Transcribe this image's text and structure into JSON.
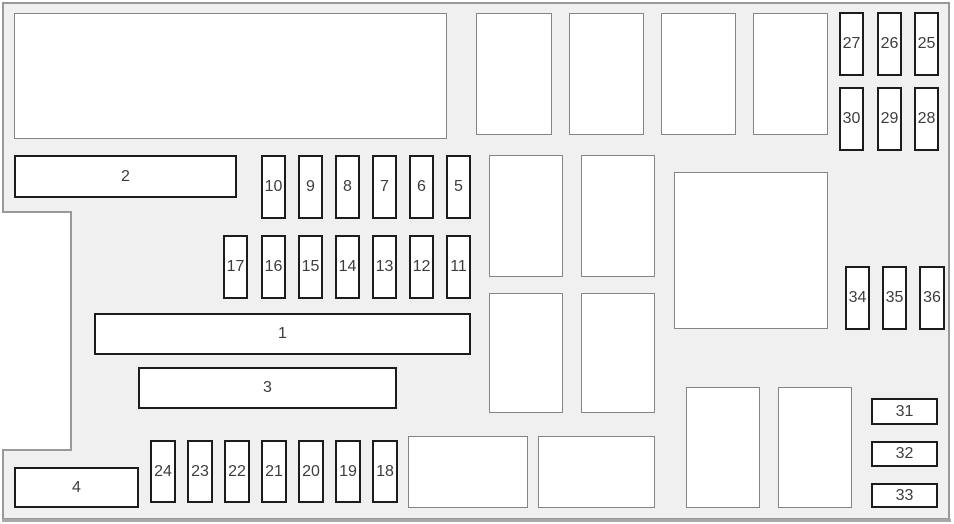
{
  "diagram": {
    "name": "fuse-box-layout-diagram",
    "colors": {
      "panel_fill": "#f0f0f0",
      "panel_stroke": "#999999",
      "panel_bottom_edge": "#a8a8a8",
      "slot_fill": "#ffffff",
      "bold_border": "#1c1c1c",
      "light_border": "#848484",
      "label_text": "#3d3d3d"
    },
    "outline_points": "3,3 949,3 949,519 3,519 3,450 71,450 71,212 3,212",
    "bottom_edge": {
      "x1": 2,
      "y1": 520.5,
      "x2": 951,
      "y2": 520.5,
      "width": 3
    },
    "boxes": [
      {
        "id": "fuse-strip-2",
        "label": "2",
        "x": 14,
        "y": 155,
        "w": 223,
        "h": 43,
        "style": "bold"
      },
      {
        "id": "fuse-strip-1",
        "label": "1",
        "x": 94,
        "y": 313,
        "w": 377,
        "h": 42,
        "style": "bold"
      },
      {
        "id": "fuse-strip-3",
        "label": "3",
        "x": 138,
        "y": 367,
        "w": 259,
        "h": 42,
        "style": "bold"
      },
      {
        "id": "fuse-strip-4",
        "label": "4",
        "x": 14,
        "y": 467,
        "w": 125,
        "h": 41,
        "style": "bold"
      },
      {
        "id": "fuse-10",
        "label": "10",
        "x": 261,
        "y": 155,
        "w": 25,
        "h": 64,
        "style": "bold"
      },
      {
        "id": "fuse-9",
        "label": "9",
        "x": 298,
        "y": 155,
        "w": 25,
        "h": 64,
        "style": "bold"
      },
      {
        "id": "fuse-8",
        "label": "8",
        "x": 335,
        "y": 155,
        "w": 25,
        "h": 64,
        "style": "bold"
      },
      {
        "id": "fuse-7",
        "label": "7",
        "x": 372,
        "y": 155,
        "w": 25,
        "h": 64,
        "style": "bold"
      },
      {
        "id": "fuse-6",
        "label": "6",
        "x": 409,
        "y": 155,
        "w": 25,
        "h": 64,
        "style": "bold"
      },
      {
        "id": "fuse-5",
        "label": "5",
        "x": 446,
        "y": 155,
        "w": 25,
        "h": 64,
        "style": "bold"
      },
      {
        "id": "fuse-17",
        "label": "17",
        "x": 223,
        "y": 235,
        "w": 25,
        "h": 64,
        "style": "bold"
      },
      {
        "id": "fuse-16",
        "label": "16",
        "x": 261,
        "y": 235,
        "w": 25,
        "h": 64,
        "style": "bold"
      },
      {
        "id": "fuse-15",
        "label": "15",
        "x": 298,
        "y": 235,
        "w": 25,
        "h": 64,
        "style": "bold"
      },
      {
        "id": "fuse-14",
        "label": "14",
        "x": 335,
        "y": 235,
        "w": 25,
        "h": 64,
        "style": "bold"
      },
      {
        "id": "fuse-13",
        "label": "13",
        "x": 372,
        "y": 235,
        "w": 25,
        "h": 64,
        "style": "bold"
      },
      {
        "id": "fuse-12",
        "label": "12",
        "x": 409,
        "y": 235,
        "w": 25,
        "h": 64,
        "style": "bold"
      },
      {
        "id": "fuse-11",
        "label": "11",
        "x": 446,
        "y": 235,
        "w": 25,
        "h": 64,
        "style": "bold"
      },
      {
        "id": "fuse-24",
        "label": "24",
        "x": 150,
        "y": 440,
        "w": 26,
        "h": 63,
        "style": "bold"
      },
      {
        "id": "fuse-23",
        "label": "23",
        "x": 187,
        "y": 440,
        "w": 26,
        "h": 63,
        "style": "bold"
      },
      {
        "id": "fuse-22",
        "label": "22",
        "x": 224,
        "y": 440,
        "w": 26,
        "h": 63,
        "style": "bold"
      },
      {
        "id": "fuse-21",
        "label": "21",
        "x": 261,
        "y": 440,
        "w": 26,
        "h": 63,
        "style": "bold"
      },
      {
        "id": "fuse-20",
        "label": "20",
        "x": 298,
        "y": 440,
        "w": 26,
        "h": 63,
        "style": "bold"
      },
      {
        "id": "fuse-19",
        "label": "19",
        "x": 335,
        "y": 440,
        "w": 26,
        "h": 63,
        "style": "bold"
      },
      {
        "id": "fuse-18",
        "label": "18",
        "x": 372,
        "y": 440,
        "w": 26,
        "h": 63,
        "style": "bold"
      },
      {
        "id": "fuse-27",
        "label": "27",
        "x": 839,
        "y": 12,
        "w": 25,
        "h": 64,
        "style": "bold"
      },
      {
        "id": "fuse-26",
        "label": "26",
        "x": 877,
        "y": 12,
        "w": 25,
        "h": 64,
        "style": "bold"
      },
      {
        "id": "fuse-25",
        "label": "25",
        "x": 914,
        "y": 12,
        "w": 25,
        "h": 64,
        "style": "bold"
      },
      {
        "id": "fuse-30",
        "label": "30",
        "x": 839,
        "y": 87,
        "w": 25,
        "h": 64,
        "style": "bold"
      },
      {
        "id": "fuse-29",
        "label": "29",
        "x": 877,
        "y": 87,
        "w": 25,
        "h": 64,
        "style": "bold"
      },
      {
        "id": "fuse-28",
        "label": "28",
        "x": 914,
        "y": 87,
        "w": 25,
        "h": 64,
        "style": "bold"
      },
      {
        "id": "fuse-34",
        "label": "34",
        "x": 845,
        "y": 266,
        "w": 25,
        "h": 64,
        "style": "bold"
      },
      {
        "id": "fuse-35",
        "label": "35",
        "x": 882,
        "y": 266,
        "w": 25,
        "h": 64,
        "style": "bold"
      },
      {
        "id": "fuse-36",
        "label": "36",
        "x": 919,
        "y": 266,
        "w": 26,
        "h": 64,
        "style": "bold"
      },
      {
        "id": "fuse-31",
        "label": "31",
        "x": 871,
        "y": 398,
        "w": 67,
        "h": 27,
        "style": "bold"
      },
      {
        "id": "fuse-32",
        "label": "32",
        "x": 871,
        "y": 441,
        "w": 67,
        "h": 26,
        "style": "bold"
      },
      {
        "id": "fuse-33",
        "label": "33",
        "x": 871,
        "y": 483,
        "w": 67,
        "h": 25,
        "style": "bold"
      },
      {
        "id": "module-slot-top-left",
        "label": "",
        "x": 14,
        "y": 13,
        "w": 433,
        "h": 126,
        "style": "light"
      },
      {
        "id": "relay-slot-top-1",
        "label": "",
        "x": 476,
        "y": 13,
        "w": 76,
        "h": 122,
        "style": "light"
      },
      {
        "id": "relay-slot-top-2",
        "label": "",
        "x": 569,
        "y": 13,
        "w": 75,
        "h": 122,
        "style": "light"
      },
      {
        "id": "relay-slot-top-3",
        "label": "",
        "x": 661,
        "y": 13,
        "w": 75,
        "h": 122,
        "style": "light"
      },
      {
        "id": "relay-slot-top-4",
        "label": "",
        "x": 753,
        "y": 13,
        "w": 75,
        "h": 122,
        "style": "light"
      },
      {
        "id": "relay-slot-mid-1",
        "label": "",
        "x": 489,
        "y": 155,
        "w": 74,
        "h": 122,
        "style": "light"
      },
      {
        "id": "relay-slot-mid-2",
        "label": "",
        "x": 581,
        "y": 155,
        "w": 74,
        "h": 122,
        "style": "light"
      },
      {
        "id": "module-slot-square",
        "label": "",
        "x": 674,
        "y": 172,
        "w": 154,
        "h": 157,
        "style": "light"
      },
      {
        "id": "relay-slot-mid-3",
        "label": "",
        "x": 489,
        "y": 293,
        "w": 74,
        "h": 120,
        "style": "light"
      },
      {
        "id": "relay-slot-mid-4",
        "label": "",
        "x": 581,
        "y": 293,
        "w": 74,
        "h": 120,
        "style": "light"
      },
      {
        "id": "module-slot-bottom-1",
        "label": "",
        "x": 408,
        "y": 436,
        "w": 120,
        "h": 72,
        "style": "light"
      },
      {
        "id": "module-slot-bottom-2",
        "label": "",
        "x": 538,
        "y": 436,
        "w": 117,
        "h": 72,
        "style": "light"
      },
      {
        "id": "relay-slot-bottom-1",
        "label": "",
        "x": 686,
        "y": 387,
        "w": 74,
        "h": 121,
        "style": "light"
      },
      {
        "id": "relay-slot-bottom-2",
        "label": "",
        "x": 778,
        "y": 387,
        "w": 74,
        "h": 121,
        "style": "light"
      }
    ]
  }
}
